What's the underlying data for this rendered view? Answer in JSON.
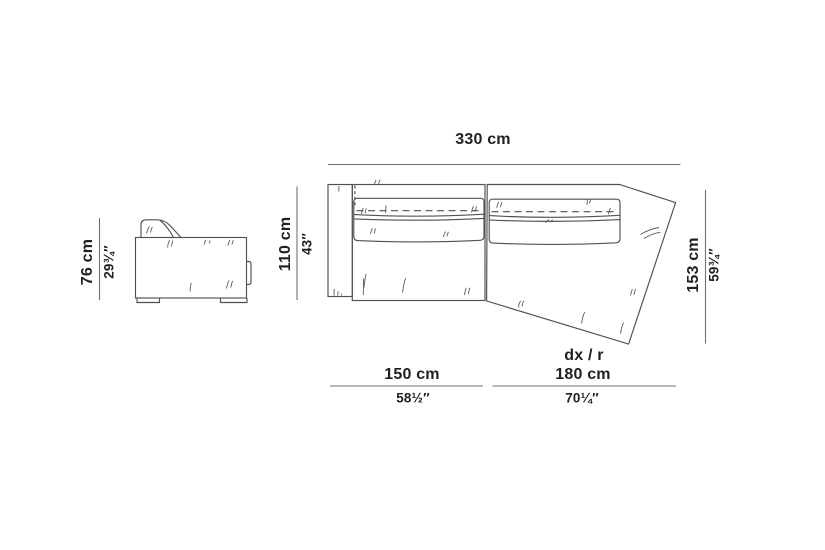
{
  "diagram": {
    "background": "#ffffff",
    "colors": {
      "outline": "#4f5052",
      "wrinkle": "#5a5b5d",
      "dimension_line": "#707174",
      "text": "#231f20"
    },
    "side_view": {
      "height_cm": "76 cm",
      "height_in": "29¾″"
    },
    "plan_view": {
      "overall_width_cm": "330 cm",
      "seat_depth_cm": "110 cm",
      "seat_depth_in": "43″",
      "chaise_depth_cm": "153 cm",
      "chaise_depth_in": "59¾″",
      "left_module_cm": "150 cm",
      "left_module_in": "58½″",
      "right_module_variant": "dx / r",
      "right_module_cm": "180 cm",
      "right_module_in": "70¼″"
    }
  }
}
